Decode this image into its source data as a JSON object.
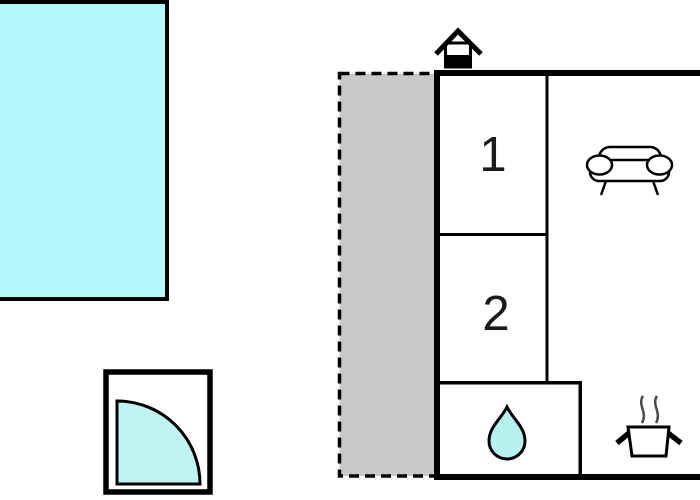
{
  "diagram": {
    "kind": "floor-plan"
  },
  "rooms": [
    {
      "label": "1"
    },
    {
      "label": "2"
    }
  ],
  "icons": {
    "entrance": "house-icon",
    "living_area": "sofa-icon",
    "bathroom": "water-drop-icon",
    "kitchen": "cooking-pot-icon",
    "door": "door-swing-quarter-circle-icon",
    "pool": "pool-rectangle"
  },
  "colors": {
    "pool": "#b2f8fd",
    "terrace": "#c9c9c9",
    "water_drop": "#b5f2f0",
    "door_swing": "#bff4f2",
    "walls": "#000000",
    "steam": "#4a4a4a",
    "background": "#ffffff"
  }
}
